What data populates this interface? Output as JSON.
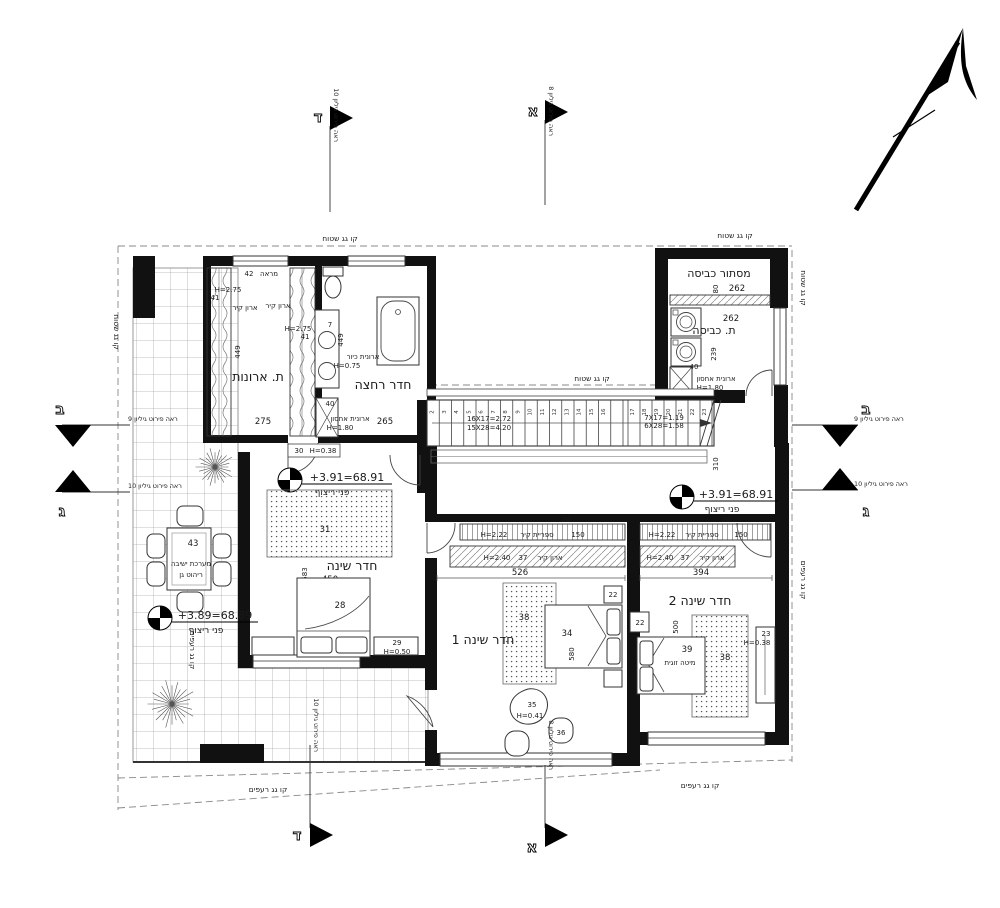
{
  "labels": {
    "roof_flat": "קו גג שטוח",
    "roof_tile": "קו גג רעפים",
    "floor_label": "פני ריצוף"
  },
  "markers": {
    "a": {
      "letter": "א",
      "note": "ראה פירוט גיליון 8"
    },
    "b": {
      "letter": "ב",
      "note": "ראה פירוט גיליון 9"
    },
    "g": {
      "letter": "ג",
      "note": "ראה פירוט גיליון 10"
    },
    "d": {
      "letter": "ד",
      "note": "ראה פירוט גיליון 10"
    }
  },
  "elevations": {
    "hall_left": "+3.91=68.91",
    "hall_right": "+3.91=68.91",
    "terrace": "+3.89=68.89"
  },
  "closet_room": {
    "name": "ת. ארונות",
    "mirror": "מראה",
    "mirror_num": "42",
    "wardrobe": "ארון קיר",
    "h275": "H=2.75",
    "d41": "41",
    "len449": "449",
    "w275": "275",
    "cab30": "30",
    "cab30_h": "H=0.38"
  },
  "bathroom": {
    "name": "חדר רחצה",
    "sink_cab": "ארונית כיור",
    "sink_cab_h": "H=0.75",
    "storage": "ארונית אחסון",
    "storage_h": "H=1.80",
    "d7": "7",
    "len449": "449",
    "w40": "40",
    "len265": "265"
  },
  "laundry": {
    "screen_name": "מסתור כביסה",
    "name": "ת. כביסה",
    "d80": "80",
    "w262a": "262",
    "w262b": "262",
    "d239": "239",
    "w40": "40",
    "storage": "ארונית אחסון",
    "storage_h": "H=1.80"
  },
  "stairs": {
    "f1a": "16X17=2.72",
    "f1b": "15X28=4.20",
    "f2a": "7X17=1.19",
    "f2b": "6X28=1.58",
    "w310": "310",
    "steps1": [
      "2",
      "3",
      "4",
      "5",
      "6",
      "7",
      "8",
      "9",
      "10",
      "11",
      "12",
      "13",
      "14",
      "15",
      "16"
    ],
    "steps2": [
      "17",
      "18",
      "19",
      "20",
      "21",
      "22",
      "23"
    ]
  },
  "master": {
    "name": "חדר שינה",
    "rug": "31",
    "len583": "583",
    "w450": "450",
    "bed": "28",
    "bench": "29",
    "bench_h": "H=0.50"
  },
  "terrace": {
    "table": "43",
    "seating1": "מערכת ישיבה",
    "seating2": "ריהוט גן"
  },
  "bedroom1": {
    "name": "חדר שינה 1",
    "shelf": "ספריית קיר",
    "shelf_h": "H=2.22",
    "shelf_d20": "20",
    "shelf_l150": "150",
    "closet": "ארון קיר",
    "closet_h": "H=2.40",
    "closet_d37": "37",
    "w526": "526",
    "rug": "38",
    "bed": "34",
    "len580": "580",
    "nightstand": "22",
    "pouf": "35",
    "pouf_h": "H=0.41",
    "chair": "36"
  },
  "bedroom2": {
    "name": "חדר שינה 2",
    "shelf": "ספריית קיר",
    "shelf_h": "H=2.22",
    "shelf_d20": "20",
    "shelf_l150": "150",
    "closet": "ארון קיר",
    "closet_h": "H=2.40",
    "closet_d37": "37",
    "w394": "394",
    "len500": "500",
    "rug": "38",
    "bed": "39",
    "bed_type": "מיטה זוגית",
    "nightstand": "22",
    "dresser": "23",
    "dresser_h": "H=0.38"
  }
}
